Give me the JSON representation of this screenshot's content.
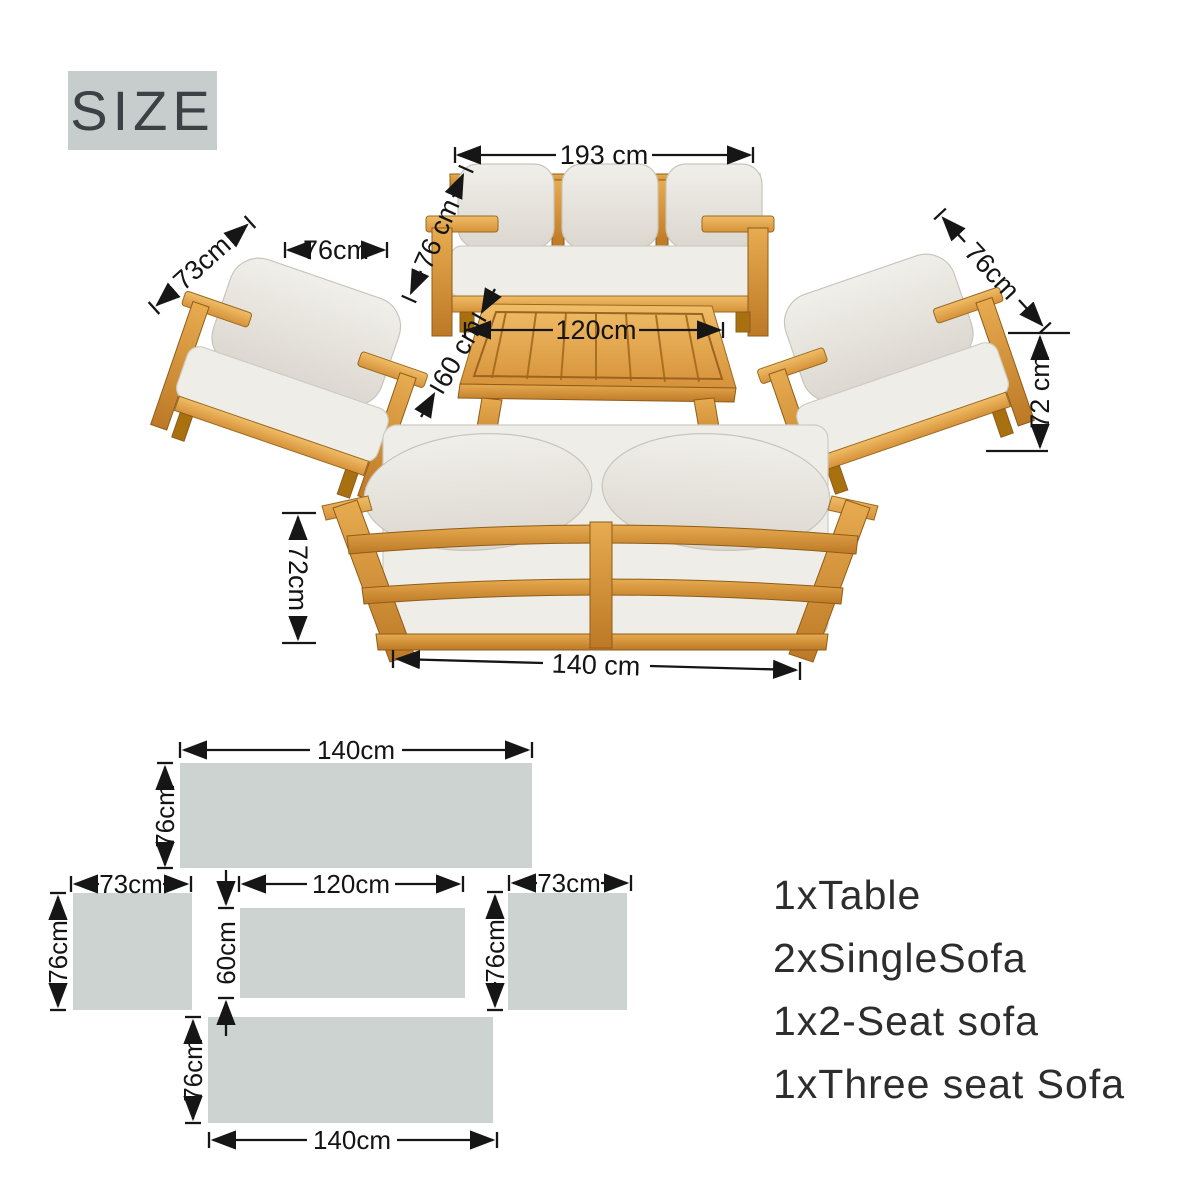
{
  "title_badge": {
    "label": "SIZE"
  },
  "colors": {
    "badge_bg": "#c6cdcc",
    "badge_text": "#3b4144",
    "wood": "#cf8c35",
    "wood_light": "#e9b35c",
    "cushion": "#eae7e1",
    "dimension_line": "#161616",
    "floor_plan_fill": "#ccd3d1",
    "background": "#ffffff"
  },
  "photo_view": {
    "three_seat_sofa": {
      "width": "193 cm",
      "depth": "76 cm"
    },
    "single_sofa_left": {
      "depth": "73cm",
      "width": "76cm"
    },
    "single_sofa_right": {
      "depth": "76cm",
      "height": "72 cm"
    },
    "table": {
      "length": "120cm",
      "depth": "60 cm"
    },
    "two_seat_sofa": {
      "height": "72cm",
      "width": "140 cm"
    }
  },
  "floor_plan": {
    "two_seat_sofa": {
      "width": "140cm",
      "depth": "76cm"
    },
    "single_sofa_left": {
      "width": "73cm",
      "depth": "76cm"
    },
    "table": {
      "width": "120cm",
      "depth": "60cm"
    },
    "single_sofa_right": {
      "width": "73cm",
      "depth": "76cm"
    },
    "three_seat_sofa": {
      "width": "140cm",
      "depth": "76cm"
    }
  },
  "package_contents": {
    "items": [
      "1xTable",
      "2xSingleSofa",
      "1x2-Seat sofa",
      "1xThree seat Sofa"
    ]
  }
}
